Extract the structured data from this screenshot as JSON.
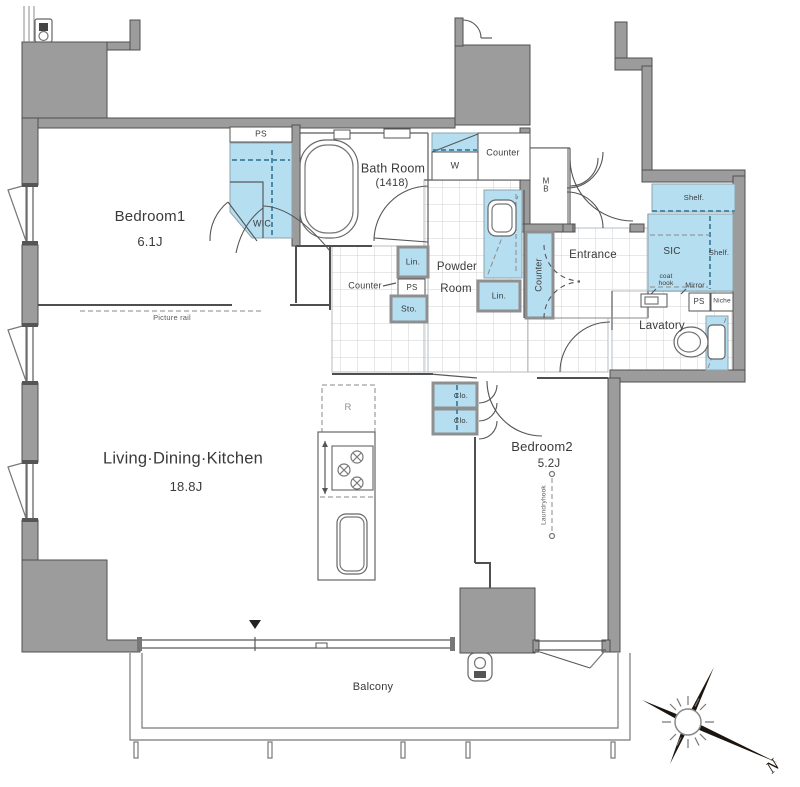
{
  "title": "Apartment floor plan",
  "colors": {
    "wall_fill": "#9c9c9c",
    "wall_stroke": "#4f4f4f",
    "fixture_blue": "#b6def1",
    "tile_line": "#cdd2d6",
    "dash_blue": "#4e89a8"
  },
  "labels": {
    "bedroom1": "Bedroom1",
    "bedroom1_size": "6.1J",
    "wic": "WIC",
    "ps": "PS",
    "bath": "Bath Room",
    "bath_size": "(1418)",
    "w": "W",
    "counter": "Counter",
    "mb_line1": "M",
    "mb_line2": "B",
    "powder_line1": "Powder",
    "powder_line2": "Room",
    "lin": "Lin.",
    "sto": "Sto.",
    "entrance": "Entrance",
    "shelf": "Shelf.",
    "sic": "SIC",
    "coat_hook_line1": "coat",
    "coat_hook_line2": "hook",
    "mirror": "Mirror",
    "niche": "Niche",
    "lavatory": "Lavatory",
    "ldk": "Living·Dining·Kitchen",
    "ldk_size": "18.8J",
    "picture_rail": "Picture rail",
    "r": "R",
    "clo": "Clo.",
    "bedroom2": "Bedroom2",
    "bedroom2_size": "5.2J",
    "laundry_hook": "Laundryhook",
    "balcony": "Balcony",
    "compass_n": "N"
  }
}
